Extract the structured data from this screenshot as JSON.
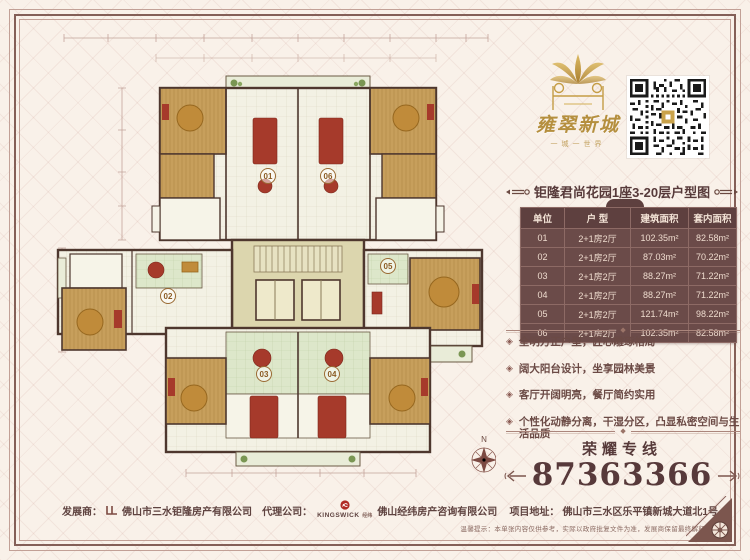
{
  "brand": {
    "name": "雍翠新城",
    "tagline": "一城一世界"
  },
  "header": {
    "title": "钜隆君尚花园1座3-20层户型图"
  },
  "table": {
    "headers": [
      "单位",
      "户 型",
      "建筑面积",
      "套内面积"
    ],
    "rows": [
      [
        "01",
        "2+1房2厅",
        "102.35m²",
        "82.58m²"
      ],
      [
        "02",
        "2+1房2厅",
        "87.03m²",
        "70.22m²"
      ],
      [
        "03",
        "2+1房2厅",
        "88.27m²",
        "71.22m²"
      ],
      [
        "04",
        "2+1房2厅",
        "88.27m²",
        "71.22m²"
      ],
      [
        "05",
        "2+1房2厅",
        "121.74m²",
        "98.22m²"
      ],
      [
        "06",
        "2+1房2厅",
        "102.35m²",
        "82.58m²"
      ]
    ]
  },
  "features": {
    "items": [
      "全明方正户型，匠心雕琢格局",
      "阔大阳台设计，坐享园林美景",
      "客厅开阔明亮，餐厅简约实用",
      "个性化动静分离，干湿分区，凸显私密空间与生活品质"
    ],
    "bullet": "◈"
  },
  "hotline": {
    "label": "荣耀专线",
    "number": "87363366"
  },
  "floorplan": {
    "units": [
      "01",
      "02",
      "03",
      "04",
      "05",
      "06"
    ],
    "compass": "N"
  },
  "footer": {
    "developer_label": "发展商：",
    "developer": "佛山市三水钜隆房产有限公司",
    "agency_label": "代理公司：",
    "agency_brand": "KINGSWICK",
    "agency_brand_suffix": "经纬",
    "agency": "佛山经纬房产咨询有限公司",
    "address_label": "项目地址：",
    "address": "佛山市三水区乐平镇新城大道北1号",
    "disclaimer": "温馨提示：本单张内容仅供参考，实际以政府批复文件为准，发展商保留最终解释权"
  },
  "colors": {
    "paper": "#f9f1e9",
    "frame": "#845f57",
    "table_bg": "#6b4b49",
    "table_header_bg": "#5e403f",
    "accent_text": "#573a3a",
    "gold": "#b58f3e",
    "plan_wall": "#4e372e",
    "plan_wood": "#c79f5c",
    "plan_green": "#dde7ca",
    "plan_red": "#a63a2b"
  }
}
